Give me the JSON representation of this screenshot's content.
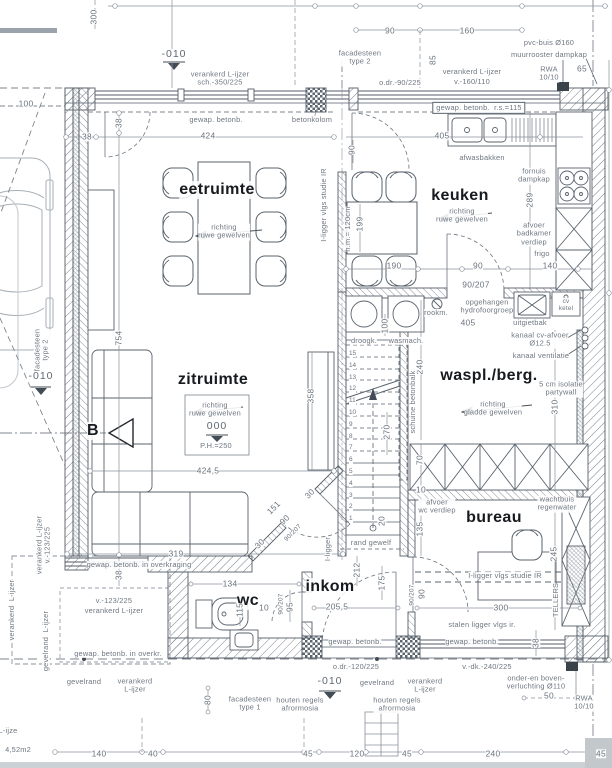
{
  "plan": {
    "colors": {
      "line": "#59636d",
      "hatch": "#76808a",
      "text": "#6e7781",
      "dark_text": "#171a1e"
    },
    "room_names": [
      "eetruimte",
      "keuken",
      "zitruimte",
      "waspl./berg.",
      "bureau",
      "inkom",
      "wc"
    ],
    "stairs": {
      "numbers": [
        "15",
        "14",
        "13",
        "12",
        "11",
        "10",
        "9",
        "8",
        "7",
        "6",
        "5",
        "4",
        "3",
        "2",
        "1"
      ]
    },
    "labels": [
      {
        "t": "eetruimte",
        "x": 217,
        "y": 190,
        "r": 0,
        "c": "room",
        "n": "room-label-eetruimte"
      },
      {
        "t": "keuken",
        "x": 460,
        "y": 196,
        "r": 0,
        "c": "room",
        "n": "room-label-keuken"
      },
      {
        "t": "zitruimte",
        "x": 213,
        "y": 380,
        "r": 0,
        "c": "room",
        "n": "room-label-zitruimte"
      },
      {
        "t": "waspl./berg.",
        "x": 489,
        "y": 376,
        "r": 0,
        "c": "room",
        "n": "room-label-waspl-berg"
      },
      {
        "t": "bureau",
        "x": 494,
        "y": 518,
        "r": 0,
        "c": "room",
        "n": "room-label-bureau"
      },
      {
        "t": "inkom",
        "x": 330,
        "y": 587,
        "r": 0,
        "c": "room",
        "n": "room-label-inkom"
      },
      {
        "t": "wc",
        "x": 248,
        "y": 601,
        "r": 0,
        "c": "room",
        "n": "room-label-wc"
      },
      {
        "t": "B",
        "x": 93,
        "y": 431,
        "r": 0,
        "c": "room",
        "n": "section-marker-b"
      },
      {
        "t": "90",
        "x": 390,
        "y": 31,
        "r": 0,
        "c": "dim"
      },
      {
        "t": "160",
        "x": 467,
        "y": 31,
        "r": 0,
        "c": "dim"
      },
      {
        "t": "300",
        "x": 94,
        "y": 17,
        "r": -90,
        "c": "dim"
      },
      {
        "t": "pvc-buis Ø160",
        "x": 549,
        "y": 43,
        "r": 0,
        "c": "ann"
      },
      {
        "t": "muurrooster dampkap",
        "x": 549,
        "y": 55,
        "r": 0,
        "c": "ann"
      },
      {
        "t": "facadesteen\ntype 2",
        "x": 360,
        "y": 58,
        "r": 0,
        "c": "ann"
      },
      {
        "t": "-010",
        "x": 174,
        "y": 55,
        "r": 0,
        "c": "lvl"
      },
      {
        "t": "verankerd L-ijzer\nsch.-350/225",
        "x": 220,
        "y": 79,
        "r": 0,
        "c": "ann"
      },
      {
        "t": "o.dr.-90/225",
        "x": 400,
        "y": 83,
        "r": 0,
        "c": "ann"
      },
      {
        "t": "verankerd L-ijzer",
        "x": 472,
        "y": 72,
        "r": 0,
        "c": "ann"
      },
      {
        "t": "v.-160/110",
        "x": 472,
        "y": 82,
        "r": 0,
        "c": "ann"
      },
      {
        "t": "RWA\n10/10",
        "x": 549,
        "y": 74,
        "r": 0,
        "c": "ann"
      },
      {
        "t": "65",
        "x": 582,
        "y": 69,
        "r": 0,
        "c": "dim"
      },
      {
        "t": "85",
        "x": 433,
        "y": 60,
        "r": -90,
        "c": "dim"
      },
      {
        "t": "gewap. betonb.  r.s.=115",
        "x": 479,
        "y": 108,
        "r": 0,
        "c": "ann boxed"
      },
      {
        "t": "gewap. betonb.",
        "x": 216,
        "y": 120,
        "r": 0,
        "c": "ann"
      },
      {
        "t": "betonkolom",
        "x": 312,
        "y": 120,
        "r": 0,
        "c": "ann"
      },
      {
        "t": "100",
        "x": 26,
        "y": 104,
        "r": 0,
        "c": "dim"
      },
      {
        "t": "38",
        "x": 87,
        "y": 137,
        "r": 0,
        "c": "dim"
      },
      {
        "t": "38",
        "x": 119,
        "y": 123,
        "r": -90,
        "c": "dim"
      },
      {
        "t": "424",
        "x": 208,
        "y": 136,
        "r": 0,
        "c": "dim"
      },
      {
        "t": "405",
        "x": 442,
        "y": 136,
        "r": 0,
        "c": "dim"
      },
      {
        "t": "90",
        "x": 352,
        "y": 150,
        "r": -90,
        "c": "dim"
      },
      {
        "t": "afwasbakken",
        "x": 482,
        "y": 158,
        "r": 0,
        "c": "ann"
      },
      {
        "t": "richting\nruwe gewelven",
        "x": 462,
        "y": 216,
        "r": 0,
        "c": "ann"
      },
      {
        "t": "fornuis\ndampkap",
        "x": 534,
        "y": 176,
        "r": 0,
        "c": "ann"
      },
      {
        "t": "289",
        "x": 530,
        "y": 200,
        "r": -90,
        "c": "dim"
      },
      {
        "t": "afvoer\nbadkamer\nverdiep",
        "x": 534,
        "y": 234,
        "r": 0,
        "c": "ann"
      },
      {
        "t": "frigo",
        "x": 542,
        "y": 254,
        "r": 0,
        "c": "ann"
      },
      {
        "t": "h.m.= 120cm",
        "x": 348,
        "y": 229,
        "r": -90,
        "c": "ann"
      },
      {
        "t": "199",
        "x": 360,
        "y": 224,
        "r": -90,
        "c": "dim"
      },
      {
        "t": "190",
        "x": 394,
        "y": 266,
        "r": 0,
        "c": "dim"
      },
      {
        "t": "90",
        "x": 478,
        "y": 266,
        "r": 0,
        "c": "dim"
      },
      {
        "t": "140",
        "x": 550,
        "y": 266,
        "r": 0,
        "c": "dim"
      },
      {
        "t": "richting\nruwe gewelven",
        "x": 224,
        "y": 232,
        "r": 0,
        "c": "ann"
      },
      {
        "t": "I-ligger vlgs studie IR",
        "x": 324,
        "y": 205,
        "r": -90,
        "c": "ann"
      },
      {
        "t": "754",
        "x": 119,
        "y": 338,
        "r": -90,
        "c": "dim"
      },
      {
        "t": "90/207",
        "x": 476,
        "y": 285,
        "r": 0,
        "c": "dim"
      },
      {
        "t": "rookm.",
        "x": 436,
        "y": 313,
        "r": 0,
        "c": "ann"
      },
      {
        "t": "opgehangen\nhydrofoorgroep",
        "x": 487,
        "y": 307,
        "r": 0,
        "c": "ann"
      },
      {
        "t": "uitgietbak",
        "x": 530,
        "y": 323,
        "r": 0,
        "c": "ann"
      },
      {
        "t": "cv\nketel",
        "x": 566,
        "y": 305,
        "r": 0,
        "c": "ann sm"
      },
      {
        "t": "405",
        "x": 468,
        "y": 323,
        "r": 0,
        "c": "dim"
      },
      {
        "t": "100",
        "x": 385,
        "y": 326,
        "r": -90,
        "c": "dim"
      },
      {
        "t": "droogk.",
        "x": 364,
        "y": 341,
        "r": 0,
        "c": "ann"
      },
      {
        "t": "wasmach.",
        "x": 406,
        "y": 341,
        "r": 0,
        "c": "ann"
      },
      {
        "t": "kanaal cv-afvoer\nØ12.5",
        "x": 540,
        "y": 340,
        "r": 0,
        "c": "ann"
      },
      {
        "t": "kanaal ventilatie",
        "x": 541,
        "y": 356,
        "r": 0,
        "c": "ann"
      },
      {
        "t": "5 cm isolatie\npartywall",
        "x": 561,
        "y": 389,
        "r": 0,
        "c": "ann"
      },
      {
        "t": "310",
        "x": 555,
        "y": 407,
        "r": -90,
        "c": "dim"
      },
      {
        "t": "richting\ngladde gewelven",
        "x": 493,
        "y": 409,
        "r": 0,
        "c": "ann"
      },
      {
        "t": "240",
        "x": 420,
        "y": 367,
        "r": -90,
        "c": "dim"
      },
      {
        "t": "schuine betonbalk",
        "x": 413,
        "y": 402,
        "r": -90,
        "c": "ann"
      },
      {
        "t": "270",
        "x": 387,
        "y": 432,
        "r": -90,
        "c": "dim"
      },
      {
        "t": "20",
        "x": 382,
        "y": 521,
        "r": -90,
        "c": "dim"
      },
      {
        "t": "richting\nruwe gewelven",
        "x": 215,
        "y": 410,
        "r": 0,
        "c": "ann"
      },
      {
        "t": "000",
        "x": 217,
        "y": 427,
        "r": 0,
        "c": "lvl"
      },
      {
        "t": "P.H.=250",
        "x": 216,
        "y": 446,
        "r": 0,
        "c": "ann"
      },
      {
        "t": "358",
        "x": 311,
        "y": 396,
        "r": -90,
        "c": "dim"
      },
      {
        "t": "424,5",
        "x": 208,
        "y": 471,
        "r": 0,
        "c": "dim"
      },
      {
        "t": "30",
        "x": 310,
        "y": 494,
        "r": -45,
        "c": "dim"
      },
      {
        "t": "151",
        "x": 274,
        "y": 508,
        "r": -45,
        "c": "dim"
      },
      {
        "t": "90",
        "x": 285,
        "y": 520,
        "r": -45,
        "c": "dim"
      },
      {
        "t": "30",
        "x": 260,
        "y": 544,
        "r": -45,
        "c": "dim"
      },
      {
        "t": "90/207",
        "x": 293,
        "y": 533,
        "r": -45,
        "c": "dim sm"
      },
      {
        "t": "rand gewelf",
        "x": 371,
        "y": 543,
        "r": 0,
        "c": "ann"
      },
      {
        "t": "I-ligger",
        "x": 328,
        "y": 549,
        "r": -90,
        "c": "ann"
      },
      {
        "t": "212",
        "x": 357,
        "y": 570,
        "r": -90,
        "c": "dim"
      },
      {
        "t": "175",
        "x": 382,
        "y": 583,
        "r": -90,
        "c": "dim"
      },
      {
        "t": "205,5",
        "x": 337,
        "y": 607,
        "r": 0,
        "c": "dim"
      },
      {
        "t": "319",
        "x": 176,
        "y": 554,
        "r": 0,
        "c": "dim"
      },
      {
        "t": "gewap. betonb. in overkraging",
        "x": 139,
        "y": 565,
        "r": 0,
        "c": "ann"
      },
      {
        "t": "38",
        "x": 119,
        "y": 575,
        "r": -90,
        "c": "dim"
      },
      {
        "t": "134",
        "x": 230,
        "y": 584,
        "r": 0,
        "c": "dim"
      },
      {
        "t": "115",
        "x": 240,
        "y": 610,
        "r": -90,
        "c": "dim"
      },
      {
        "t": "10",
        "x": 264,
        "y": 608,
        "r": 0,
        "c": "dim"
      },
      {
        "t": "90/207",
        "x": 281,
        "y": 604,
        "r": -90,
        "c": "dim sm"
      },
      {
        "t": "95",
        "x": 290,
        "y": 607,
        "r": -90,
        "c": "dim"
      },
      {
        "t": "v.-123/225",
        "x": 114,
        "y": 601,
        "r": 0,
        "c": "ann"
      },
      {
        "t": "verankerd L-ijzer",
        "x": 114,
        "y": 611,
        "r": 0,
        "c": "ann"
      },
      {
        "t": "gewap. betonb. in overkr.",
        "x": 118,
        "y": 654,
        "r": 0,
        "c": "ann"
      },
      {
        "t": "70",
        "x": 420,
        "y": 460,
        "r": -90,
        "c": "dim"
      },
      {
        "t": "10",
        "x": 421,
        "y": 490,
        "r": 0,
        "c": "dim"
      },
      {
        "t": "afvoer\nwc verdiep",
        "x": 437,
        "y": 507,
        "r": 0,
        "c": "ann"
      },
      {
        "t": "wachtbuis\nregenwater",
        "x": 557,
        "y": 504,
        "r": 0,
        "c": "ann"
      },
      {
        "t": "135",
        "x": 420,
        "y": 529,
        "r": -90,
        "c": "dim"
      },
      {
        "t": "245",
        "x": 554,
        "y": 554,
        "r": -90,
        "c": "dim"
      },
      {
        "t": "I-ligger vlgs studie IR",
        "x": 505,
        "y": 576,
        "r": 0,
        "c": "ann"
      },
      {
        "t": "90/207",
        "x": 412,
        "y": 595,
        "r": -90,
        "c": "dim sm"
      },
      {
        "t": "90",
        "x": 422,
        "y": 594,
        "r": -90,
        "c": "dim"
      },
      {
        "t": "300",
        "x": 501,
        "y": 608,
        "r": 0,
        "c": "dim"
      },
      {
        "t": "TELLERS",
        "x": 556,
        "y": 600,
        "r": -90,
        "c": "ann"
      },
      {
        "t": "38",
        "x": 536,
        "y": 643,
        "r": -90,
        "c": "dim"
      },
      {
        "t": "stalen ligger vlgs ir.",
        "x": 482,
        "y": 625,
        "r": 0,
        "c": "ann"
      },
      {
        "t": "gewap. betonb.",
        "x": 355,
        "y": 642,
        "r": 0,
        "c": "ann"
      },
      {
        "t": "gewap. betonb.",
        "x": 472,
        "y": 642,
        "r": 0,
        "c": "ann"
      },
      {
        "t": "o.dr.-120/225",
        "x": 356,
        "y": 667,
        "r": 0,
        "c": "ann"
      },
      {
        "t": "v.-dk.-240/225",
        "x": 487,
        "y": 667,
        "r": 0,
        "c": "ann"
      },
      {
        "t": "-010",
        "x": 330,
        "y": 682,
        "r": 0,
        "c": "lvl"
      },
      {
        "t": "gevelrand",
        "x": 84,
        "y": 682,
        "r": 0,
        "c": "ann"
      },
      {
        "t": "verankerd\nL-ijzer",
        "x": 135,
        "y": 686,
        "r": 0,
        "c": "ann"
      },
      {
        "t": "gevelrand",
        "x": 377,
        "y": 683,
        "r": 0,
        "c": "ann"
      },
      {
        "t": "verankerd\nL-ijzer",
        "x": 425,
        "y": 686,
        "r": 0,
        "c": "ann"
      },
      {
        "t": "onder-en boven-\nverluchting Ø110",
        "x": 536,
        "y": 683,
        "r": 0,
        "c": "ann"
      },
      {
        "t": "50",
        "x": 549,
        "y": 696,
        "r": 0,
        "c": "dim"
      },
      {
        "t": "RWA\n10/10",
        "x": 584,
        "y": 703,
        "r": 0,
        "c": "ann"
      },
      {
        "t": "80",
        "x": 208,
        "y": 700,
        "r": -90,
        "c": "dim"
      },
      {
        "t": "facadesteen\ntype 1",
        "x": 250,
        "y": 704,
        "r": 0,
        "c": "ann"
      },
      {
        "t": "houten regels\nafrormosia",
        "x": 300,
        "y": 705,
        "r": 0,
        "c": "ann"
      },
      {
        "t": "houten regels\nafrormosia",
        "x": 397,
        "y": 705,
        "r": 0,
        "c": "ann"
      },
      {
        "t": "140",
        "x": 99,
        "y": 754,
        "r": 0,
        "c": "dim"
      },
      {
        "t": "40",
        "x": 153,
        "y": 754,
        "r": 0,
        "c": "dim"
      },
      {
        "t": "45",
        "x": 308,
        "y": 754,
        "r": 0,
        "c": "dim"
      },
      {
        "t": "120",
        "x": 357,
        "y": 754,
        "r": 0,
        "c": "dim"
      },
      {
        "t": "45",
        "x": 407,
        "y": 754,
        "r": 0,
        "c": "dim"
      },
      {
        "t": "240",
        "x": 493,
        "y": 754,
        "r": 0,
        "c": "dim"
      },
      {
        "t": "45",
        "x": 601,
        "y": 754,
        "r": 0,
        "c": "dim"
      },
      {
        "t": "4,52m2",
        "x": 18,
        "y": 750,
        "r": 0,
        "c": "ann"
      },
      {
        "t": "L-ijze",
        "x": 8,
        "y": 731,
        "r": 0,
        "c": "ann"
      },
      {
        "t": "facadesteen\ntype 2",
        "x": 42,
        "y": 350,
        "r": -90,
        "c": "ann"
      },
      {
        "t": "-010",
        "x": 41,
        "y": 377,
        "r": 0,
        "c": "lvl"
      },
      {
        "t": "verankerd L-ijzer\nv.-123/225",
        "x": 44,
        "y": 545,
        "r": -90,
        "c": "ann"
      },
      {
        "t": "gevelrand  L-ijzer",
        "x": 46,
        "y": 641,
        "r": -90,
        "c": "ann"
      },
      {
        "t": "verankerd  L-ijzer",
        "x": 12,
        "y": 610,
        "r": -90,
        "c": "ann"
      }
    ]
  }
}
